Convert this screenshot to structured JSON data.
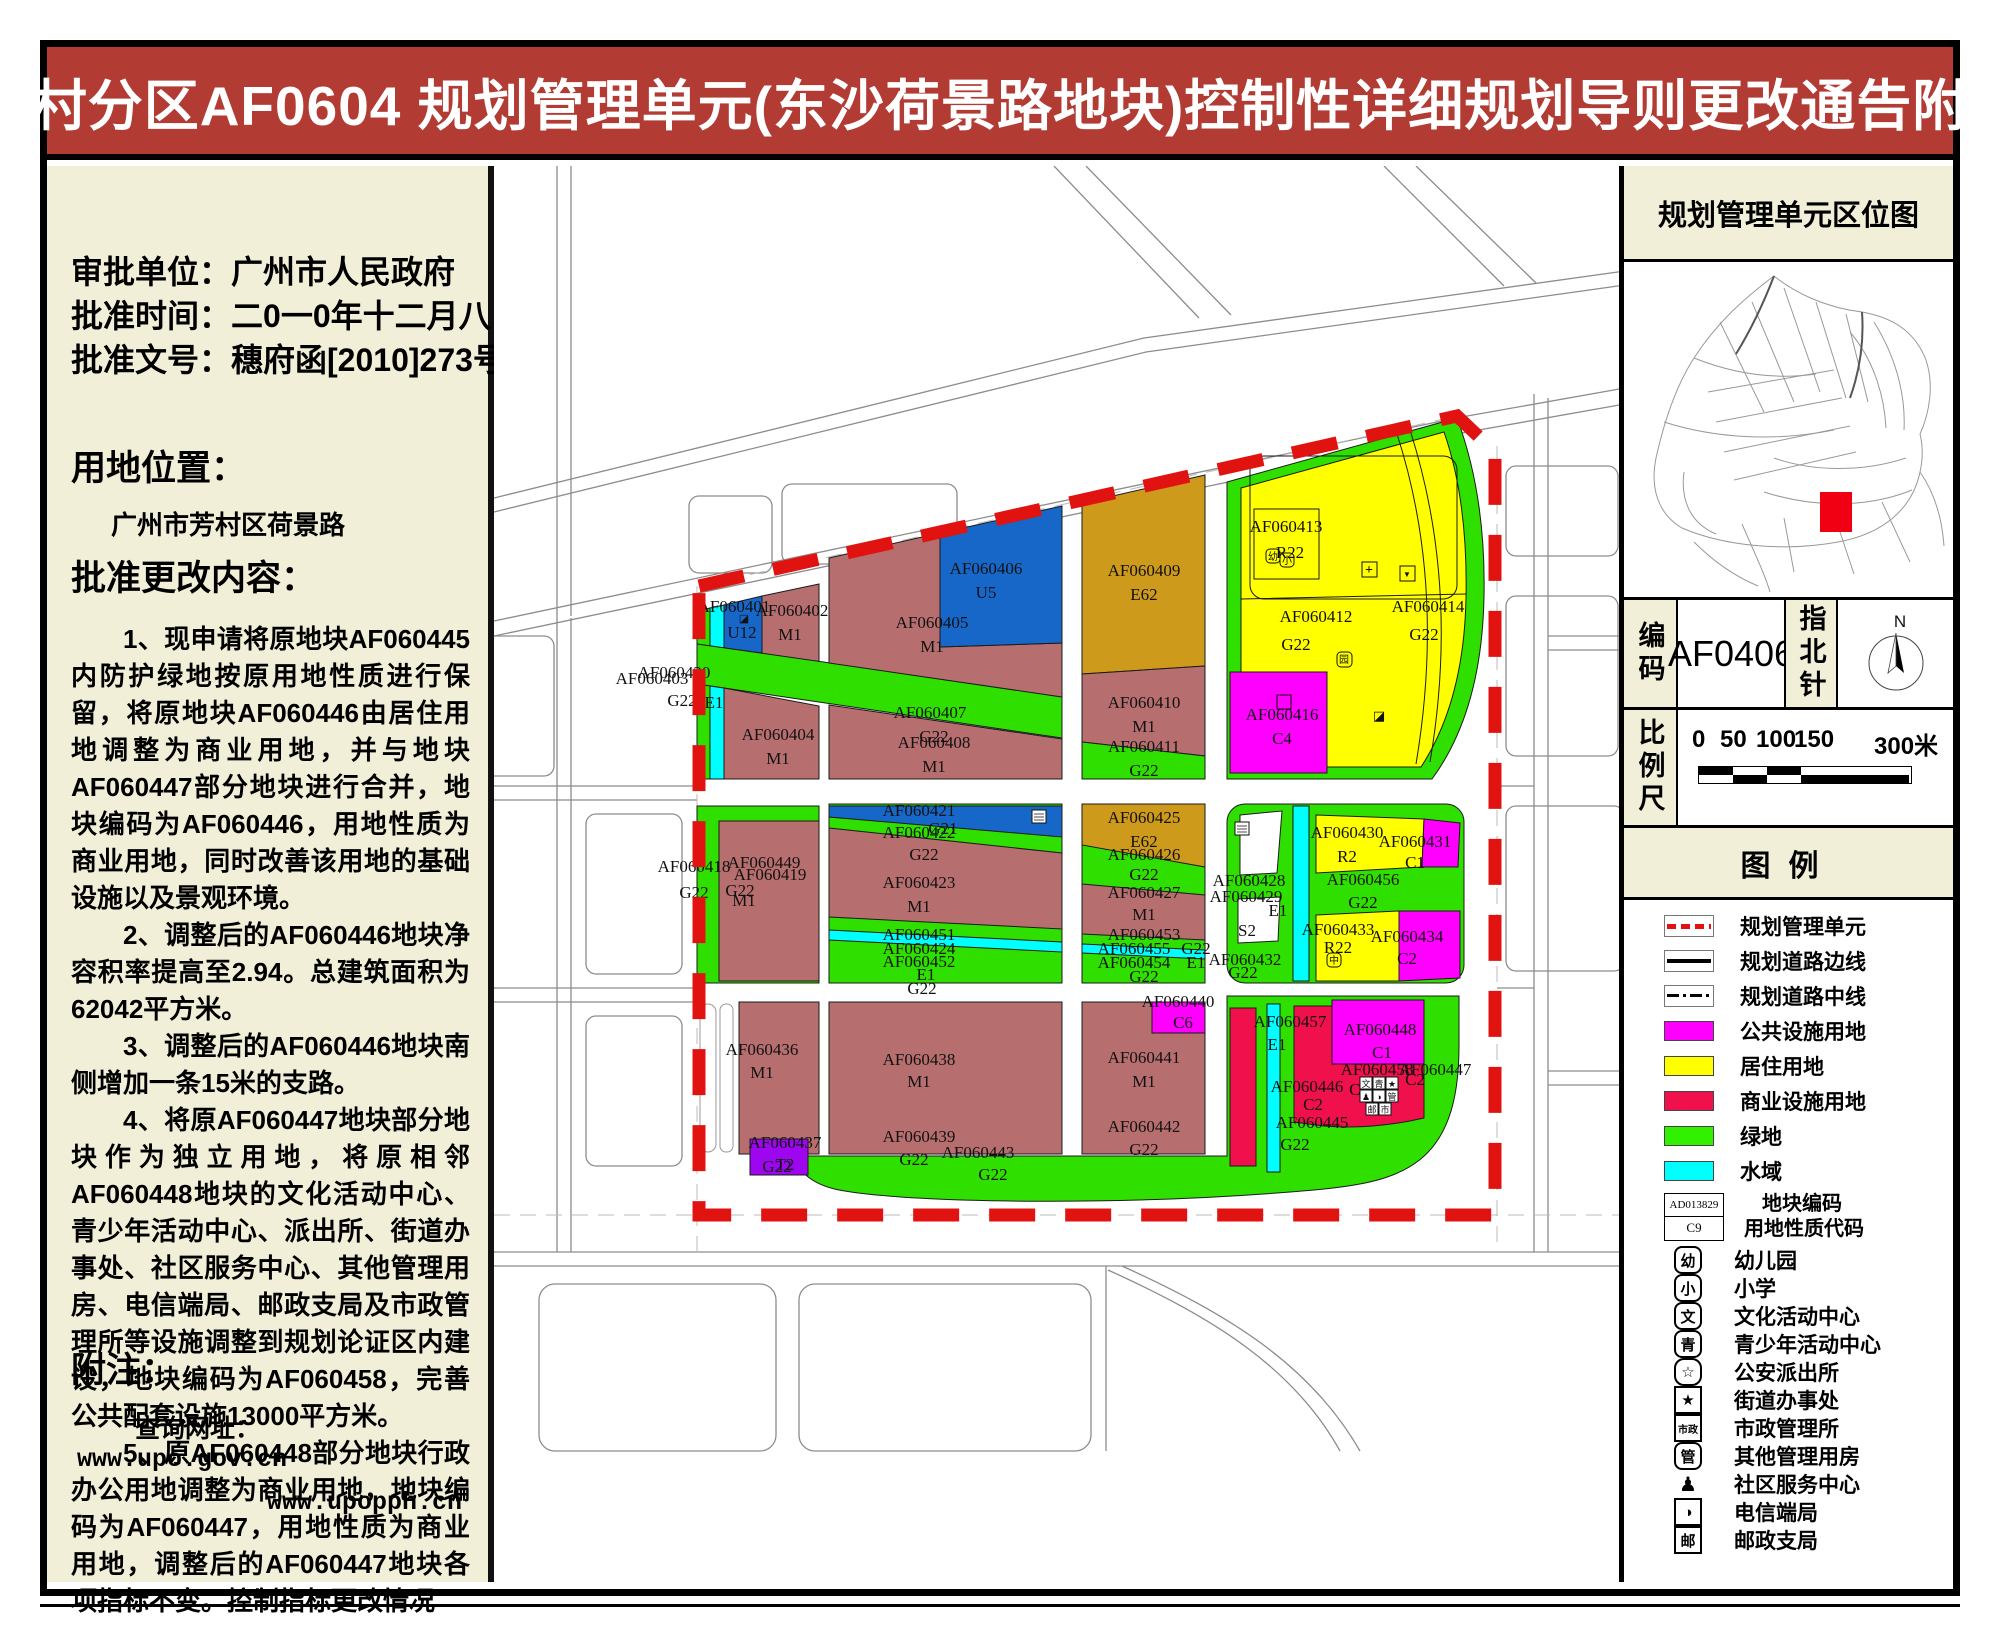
{
  "title": "芳村分区AF0604 规划管理单元(东沙荷景路地块)控制性详细规划导则更改通告附图",
  "colors": {
    "titlebar": "#B23B34",
    "panel_beige": "#F2EFD8",
    "boundary_red": "#E01310",
    "residential_yellow": "#FFFF00",
    "public_magenta": "#FF00FF",
    "commercial_red": "#F0104C",
    "green_space": "#2FDF00",
    "water_cyan": "#00FFFF",
    "industry_brown": "#B66E6E",
    "special_tan": "#CE9A1C",
    "utility_blue": "#1767C9",
    "transport_purple": "#9D06EF"
  },
  "left_panel": {
    "approval": [
      {
        "label": "审批单位：",
        "value": "广州市人民政府"
      },
      {
        "label": "批准时间：",
        "value": "二0一0年十二月八日"
      },
      {
        "label": "批准文号：",
        "value": "穗府函[2010]273号"
      }
    ],
    "location_title": "用地位置：",
    "location_value": "广州市芳村区荷景路",
    "content_title": "批准更改内容：",
    "paragraphs": [
      "1、现申请将原地块AF060445内防护绿地按原用地性质进行保留，将原地块AF060446由居住用地调整为商业用地，并与地块AF060447部分地块进行合并，地块编码为AF060446，用地性质为商业用地，同时改善该用地的基础设施以及景观环境。",
      "2、调整后的AF060446地块净容积率提高至2.94。总建筑面积为62042平方米。",
      "3、调整后的AF060446地块南侧增加一条15米的支路。",
      "4、将原AF060447地块部分地块作为独立用地，将原相邻AF060448地块的文化活动中心、青少年活动中心、派出所、街道办事处、社区服务中心、其他管理用房、电信端局、邮政支局及市政管理所等设施调整到规划论证区内建设，地块编码为AF060458，完善公共配套设施13000平方米。",
      "5、原AF060448部分地块行政办公用地调整为商业用地，地块编码为AF060447，用地性质为商业用地，调整后的AF060447地块各项指标不变。控制指标更改情况"
    ],
    "note_title": "附注：",
    "note_label": "查询网址：",
    "urls": [
      "www.upo.gov.cn",
      "www.upopph.cn"
    ]
  },
  "map": {
    "labels": [
      {
        "code": "AF060420",
        "use": "G22"
      },
      {
        "code": "AF060403",
        "use": "E1"
      },
      {
        "code": "AF060401",
        "use": "U12"
      },
      {
        "code": "AF060402",
        "use": "M1"
      },
      {
        "code": "AF060404",
        "use": "M1"
      },
      {
        "code": "AF060405",
        "use": "M1"
      },
      {
        "code": "AF060406",
        "use": "U5"
      },
      {
        "code": "AF060407",
        "use": "G22"
      },
      {
        "code": "AF060408",
        "use": "M1"
      },
      {
        "code": "AF060409",
        "use": "E62"
      },
      {
        "code": "AF060410",
        "use": "M1"
      },
      {
        "code": "AF060411",
        "use": "G22"
      },
      {
        "code": "AF060413",
        "use": "R22"
      },
      {
        "code": "AF060412",
        "use": "G22"
      },
      {
        "code": "AF060414",
        "use": "G22"
      },
      {
        "code": "AF060416",
        "use": "C4"
      },
      {
        "code": "AF060418",
        "use": "G22"
      },
      {
        "code": "AF060449",
        "use": "G22"
      },
      {
        "code": "AF060419",
        "use": "M1"
      },
      {
        "code": "AF060421",
        "use": ""
      },
      {
        "code": "AF060422",
        "use": "G21"
      },
      {
        "code": "G22",
        "use": ""
      },
      {
        "code": "AF060423",
        "use": "M1"
      },
      {
        "code": "AF060451",
        "use": ""
      },
      {
        "code": "AF060424",
        "use": ""
      },
      {
        "code": "AF060452",
        "use": "E1"
      },
      {
        "code": "G22",
        "use": ""
      },
      {
        "code": "AF060425",
        "use": "E62"
      },
      {
        "code": "AF060426",
        "use": "G22"
      },
      {
        "code": "AF060427",
        "use": "M1"
      },
      {
        "code": "AF060453",
        "use": ""
      },
      {
        "code": "AF060455",
        "use": "G22"
      },
      {
        "code": "AF060454",
        "use": "E1"
      },
      {
        "code": "G22",
        "use": ""
      },
      {
        "code": "AF060428",
        "use": ""
      },
      {
        "code": "AF060429",
        "use": "E1"
      },
      {
        "code": "S2",
        "use": ""
      },
      {
        "code": "AF060430",
        "use": "R2"
      },
      {
        "code": "AF060431",
        "use": "C1"
      },
      {
        "code": "AF060456",
        "use": "G22"
      },
      {
        "code": "AF060433",
        "use": "R22"
      },
      {
        "code": "AF060434",
        "use": "C2"
      },
      {
        "code": "AF060432",
        "use": "G22"
      },
      {
        "code": "AF060440",
        "use": "C6"
      },
      {
        "code": "AF060441",
        "use": "M1"
      },
      {
        "code": "AF060442",
        "use": "G22"
      },
      {
        "code": "AF060436",
        "use": "M1"
      },
      {
        "code": "AF060438",
        "use": "M1"
      },
      {
        "code": "AF060439",
        "use": "G22"
      },
      {
        "code": "AF060443",
        "use": "G22"
      },
      {
        "code": "G22",
        "use": ""
      },
      {
        "code": "AF060437",
        "use": "T2"
      },
      {
        "code": "AF060457",
        "use": "E1"
      },
      {
        "code": "AF060448",
        "use": "C1"
      },
      {
        "code": "AF060446",
        "use": "C2"
      },
      {
        "code": "AF060458",
        "use": "C2"
      },
      {
        "code": "AF060447",
        "use": "C2"
      },
      {
        "code": "AF060445",
        "use": "G22"
      }
    ],
    "icons": {
      "kindergarten": "幼",
      "primary_school": "小",
      "hospital": "+",
      "market": "▼",
      "garden": "园",
      "halfblock": "◪",
      "center": "中",
      "cluster": [
        "文",
        "青",
        "★",
        "♟",
        "◑",
        "管",
        "邮",
        "市"
      ]
    }
  },
  "right_panel": {
    "locator_title": "规划管理单元区位图",
    "code_label": "编码",
    "code_value": "AF0406",
    "compass_label": "指北针",
    "compass_n": "N",
    "scale_label": "比例尺",
    "scale_ticks": [
      "0",
      "50",
      "100",
      "150",
      "300米"
    ],
    "legend_title": "图例",
    "legend_lines": [
      {
        "label": "规划管理单元",
        "kind": "unit-boundary"
      },
      {
        "label": "规划道路边线",
        "kind": "road-edge"
      },
      {
        "label": "规划道路中线",
        "kind": "road-center"
      }
    ],
    "legend_swatches": [
      {
        "label": "公共设施用地",
        "color": "#FF00FF"
      },
      {
        "label": "居住用地",
        "color": "#FFFF00"
      },
      {
        "label": "商业设施用地",
        "color": "#F0104C"
      },
      {
        "label": "绿地",
        "color": "#33F000"
      },
      {
        "label": "水域",
        "color": "#00FFFF"
      }
    ],
    "legend_code_box": {
      "code": "AD013829",
      "use": "C9",
      "label_line1": "地块编码",
      "label_line2": "用地性质代码"
    },
    "legend_icons": [
      {
        "glyph": "幼",
        "label": "幼儿园",
        "box": "round"
      },
      {
        "glyph": "小",
        "label": "小学",
        "box": "round"
      },
      {
        "glyph": "文",
        "label": "文化活动中心",
        "box": "round"
      },
      {
        "glyph": "青",
        "label": "青少年活动中心",
        "box": "round"
      },
      {
        "glyph": "☆",
        "label": "公安派出所",
        "box": "shield"
      },
      {
        "glyph": "★",
        "label": "街道办事处",
        "box": "square"
      },
      {
        "glyph": "市政",
        "label": "市政管理所",
        "box": "square-sm"
      },
      {
        "glyph": "管",
        "label": "其他管理用房",
        "box": "round"
      },
      {
        "glyph": "♟",
        "label": "社区服务中心",
        "box": "bare"
      },
      {
        "glyph": "◑",
        "label": "电信端局",
        "box": "square"
      },
      {
        "glyph": "邮",
        "label": "邮政支局",
        "box": "square"
      }
    ]
  }
}
